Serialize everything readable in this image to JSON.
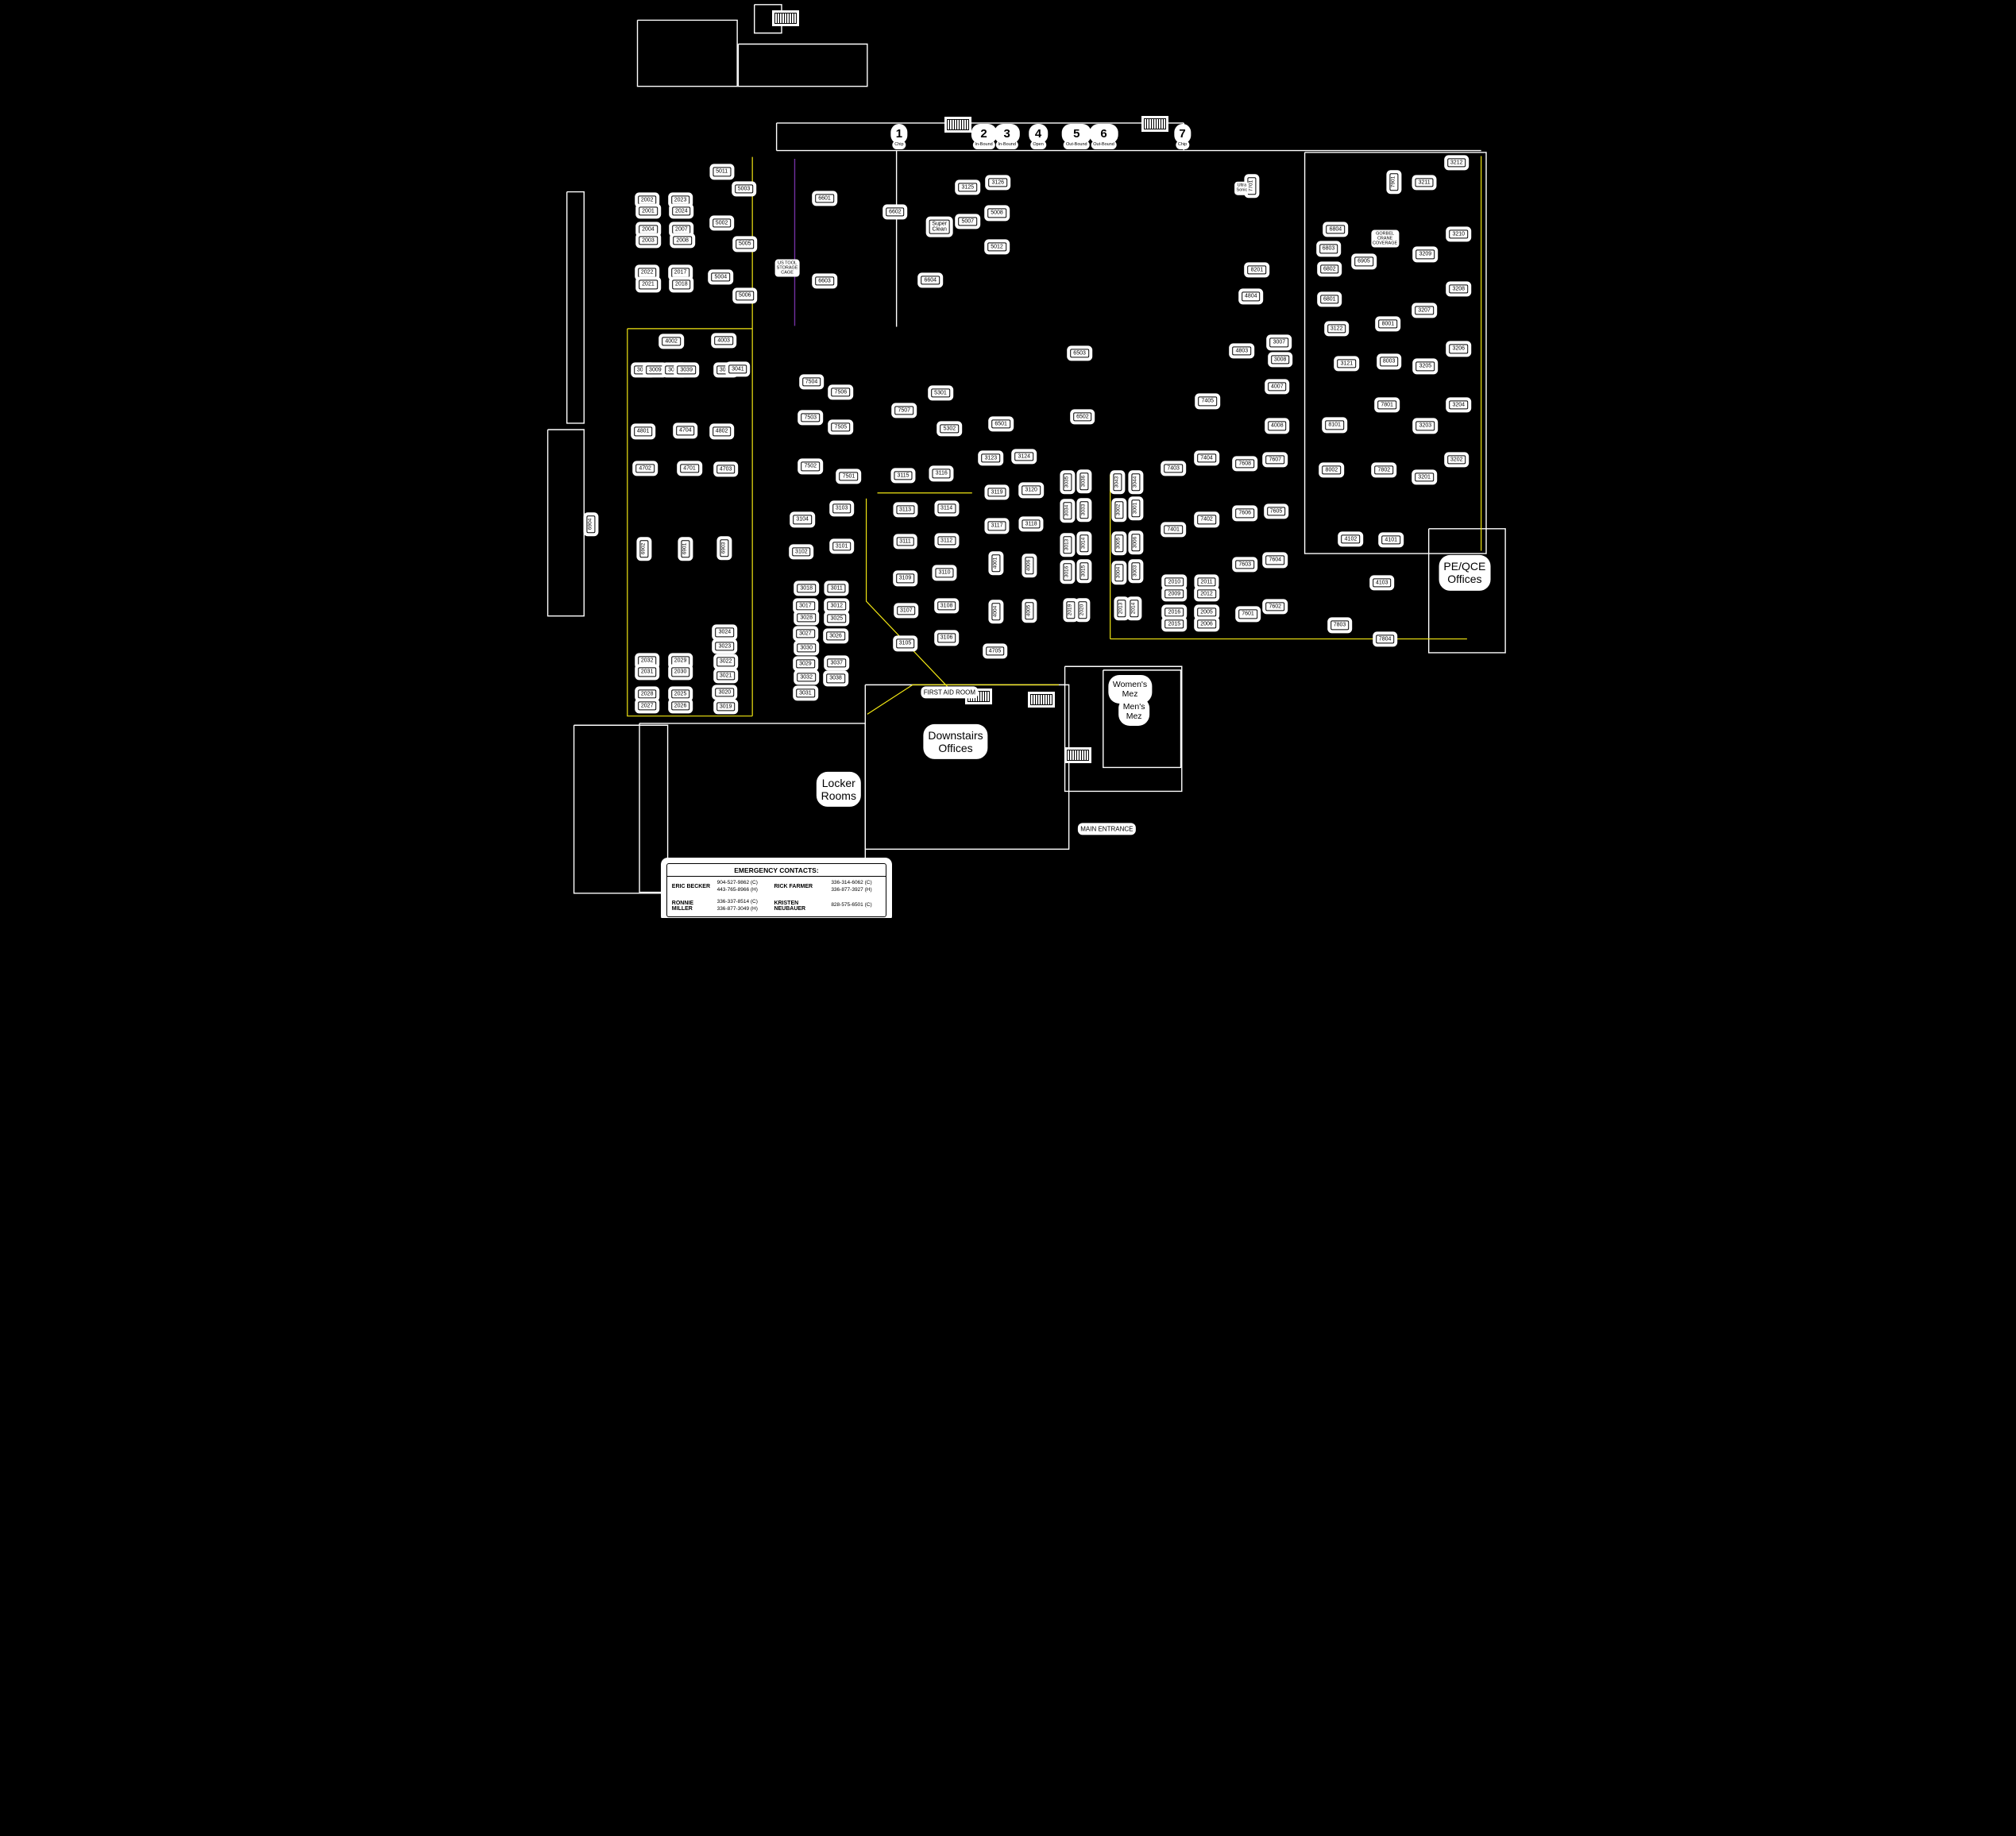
{
  "colors": {
    "background": "#000000",
    "linework": "#ffffff",
    "text": "#000000",
    "aisle_yellow": "#f2e713",
    "cage_purple": "#7030a0"
  },
  "dock_doors": [
    {
      "number": "1",
      "label": "Chip",
      "x": 39.2,
      "y": 13.9
    },
    {
      "number": "2",
      "label": "In-Bound",
      "x": 47.6,
      "y": 13.9
    },
    {
      "number": "3",
      "label": "In-Bound",
      "x": 49.9,
      "y": 13.9
    },
    {
      "number": "4",
      "label": "Open",
      "x": 53.0,
      "y": 13.9
    },
    {
      "number": "5",
      "label": "Out-Bound",
      "x": 56.8,
      "y": 13.9
    },
    {
      "number": "6",
      "label": "Out-Bound",
      "x": 59.5,
      "y": 13.9
    },
    {
      "number": "7",
      "label": "Chip",
      "x": 67.3,
      "y": 13.9
    }
  ],
  "machines": [
    {
      "t": "2002",
      "x": 14.2,
      "y": 21.8
    },
    {
      "t": "2001",
      "x": 14.3,
      "y": 23.0
    },
    {
      "t": "2004",
      "x": 14.3,
      "y": 25.0
    },
    {
      "t": "2003",
      "x": 14.3,
      "y": 26.2
    },
    {
      "t": "2022",
      "x": 14.2,
      "y": 29.7
    },
    {
      "t": "2021",
      "x": 14.3,
      "y": 31.0
    },
    {
      "t": "2023",
      "x": 17.5,
      "y": 21.8
    },
    {
      "t": "2024",
      "x": 17.6,
      "y": 23.0
    },
    {
      "t": "2007",
      "x": 17.6,
      "y": 25.0
    },
    {
      "t": "2008",
      "x": 17.7,
      "y": 26.2
    },
    {
      "t": "2017",
      "x": 17.5,
      "y": 29.7
    },
    {
      "t": "2018",
      "x": 17.6,
      "y": 31.0
    },
    {
      "t": "5011",
      "x": 21.6,
      "y": 18.7
    },
    {
      "t": "5003",
      "x": 23.8,
      "y": 20.6
    },
    {
      "t": "5002",
      "x": 21.6,
      "y": 24.3
    },
    {
      "t": "5005",
      "x": 23.9,
      "y": 26.6
    },
    {
      "t": "5004",
      "x": 21.5,
      "y": 30.2
    },
    {
      "t": "5006",
      "x": 23.9,
      "y": 32.2
    },
    {
      "t": "4002",
      "x": 16.6,
      "y": 37.2
    },
    {
      "t": "4003",
      "x": 21.8,
      "y": 37.1
    },
    {
      "t": "3010",
      "x": 13.8,
      "y": 40.3
    },
    {
      "t": "3009",
      "x": 15.0,
      "y": 40.3
    },
    {
      "t": "3040",
      "x": 16.9,
      "y": 40.3
    },
    {
      "t": "3039",
      "x": 18.1,
      "y": 40.3
    },
    {
      "t": "3042",
      "x": 22.0,
      "y": 40.3
    },
    {
      "t": "3041",
      "x": 23.2,
      "y": 40.2
    },
    {
      "t": "4801",
      "x": 13.8,
      "y": 47.0
    },
    {
      "t": "4704",
      "x": 18.0,
      "y": 46.9
    },
    {
      "t": "4802",
      "x": 21.6,
      "y": 47.0
    },
    {
      "t": "4702",
      "x": 14.0,
      "y": 51.0
    },
    {
      "t": "4701",
      "x": 18.4,
      "y": 51.0
    },
    {
      "t": "4703",
      "x": 22.0,
      "y": 51.1
    },
    {
      "t": "6904",
      "x": 8.6,
      "y": 57.1,
      "v": 1
    },
    {
      "t": "6902",
      "x": 13.9,
      "y": 59.8,
      "v": 1
    },
    {
      "t": "6901",
      "x": 18.0,
      "y": 59.8,
      "v": 1
    },
    {
      "t": "6903",
      "x": 21.9,
      "y": 59.7,
      "v": 1
    },
    {
      "t": "2032",
      "x": 14.2,
      "y": 72.0
    },
    {
      "t": "2031",
      "x": 14.2,
      "y": 73.2
    },
    {
      "t": "2029",
      "x": 17.5,
      "y": 72.0
    },
    {
      "t": "2030",
      "x": 17.5,
      "y": 73.2
    },
    {
      "t": "2028",
      "x": 14.2,
      "y": 75.6
    },
    {
      "t": "2027",
      "x": 14.2,
      "y": 76.9
    },
    {
      "t": "2025",
      "x": 17.5,
      "y": 75.6
    },
    {
      "t": "2026",
      "x": 17.5,
      "y": 76.9
    },
    {
      "t": "3024",
      "x": 21.9,
      "y": 68.9
    },
    {
      "t": "3023",
      "x": 21.9,
      "y": 70.4
    },
    {
      "t": "3022",
      "x": 22.0,
      "y": 72.1
    },
    {
      "t": "3021",
      "x": 22.0,
      "y": 73.6
    },
    {
      "t": "3020",
      "x": 21.9,
      "y": 75.4
    },
    {
      "t": "3019",
      "x": 22.0,
      "y": 77.0
    },
    {
      "t": "6601",
      "x": 31.8,
      "y": 21.6
    },
    {
      "t": "6602",
      "x": 38.8,
      "y": 23.1
    },
    {
      "t": "3125",
      "x": 46.0,
      "y": 20.4
    },
    {
      "t": "3126",
      "x": 49.0,
      "y": 19.9
    },
    {
      "t": "5007",
      "x": 46.0,
      "y": 24.1
    },
    {
      "t": "5008",
      "x": 48.9,
      "y": 23.2
    },
    {
      "t": "5012",
      "x": 48.9,
      "y": 26.9
    },
    {
      "t": "6603",
      "x": 31.8,
      "y": 30.6
    },
    {
      "t": "6604",
      "x": 42.3,
      "y": 30.5
    },
    {
      "t": "Super\nClean",
      "x": 43.2,
      "y": 24.7
    },
    {
      "t": "7504",
      "x": 30.5,
      "y": 41.6
    },
    {
      "t": "7506",
      "x": 33.4,
      "y": 42.7
    },
    {
      "t": "7503",
      "x": 30.4,
      "y": 45.5
    },
    {
      "t": "7505",
      "x": 33.4,
      "y": 46.5
    },
    {
      "t": "7502",
      "x": 30.4,
      "y": 50.8
    },
    {
      "t": "7501",
      "x": 34.2,
      "y": 51.9
    },
    {
      "t": "7507",
      "x": 39.7,
      "y": 44.7
    },
    {
      "t": "5301",
      "x": 43.3,
      "y": 42.8
    },
    {
      "t": "5302",
      "x": 44.2,
      "y": 46.7
    },
    {
      "t": "6501",
      "x": 49.3,
      "y": 46.2
    },
    {
      "t": "6502",
      "x": 57.4,
      "y": 45.4
    },
    {
      "t": "6503",
      "x": 57.1,
      "y": 38.5
    },
    {
      "t": "3115",
      "x": 39.6,
      "y": 51.8
    },
    {
      "t": "3116",
      "x": 43.4,
      "y": 51.6
    },
    {
      "t": "3113",
      "x": 39.8,
      "y": 55.5
    },
    {
      "t": "3114",
      "x": 43.9,
      "y": 55.4
    },
    {
      "t": "3111",
      "x": 39.8,
      "y": 59.0
    },
    {
      "t": "3112",
      "x": 43.9,
      "y": 58.9
    },
    {
      "t": "3109",
      "x": 39.8,
      "y": 63.0
    },
    {
      "t": "3110",
      "x": 43.7,
      "y": 62.4
    },
    {
      "t": "3107",
      "x": 39.9,
      "y": 66.5
    },
    {
      "t": "3108",
      "x": 43.9,
      "y": 66.0
    },
    {
      "t": "3105",
      "x": 39.8,
      "y": 70.1
    },
    {
      "t": "3106",
      "x": 43.9,
      "y": 69.5
    },
    {
      "t": "3104",
      "x": 29.6,
      "y": 56.6
    },
    {
      "t": "3103",
      "x": 33.5,
      "y": 55.4
    },
    {
      "t": "3102",
      "x": 29.5,
      "y": 60.1
    },
    {
      "t": "3101",
      "x": 33.5,
      "y": 59.5
    },
    {
      "t": "3018",
      "x": 30.0,
      "y": 64.1
    },
    {
      "t": "3017",
      "x": 29.9,
      "y": 66.0
    },
    {
      "t": "3028",
      "x": 30.0,
      "y": 67.3
    },
    {
      "t": "3027",
      "x": 29.9,
      "y": 69.0
    },
    {
      "t": "3030",
      "x": 30.0,
      "y": 70.6
    },
    {
      "t": "3029",
      "x": 29.9,
      "y": 72.3
    },
    {
      "t": "3032",
      "x": 30.0,
      "y": 73.8
    },
    {
      "t": "3031",
      "x": 29.9,
      "y": 75.5
    },
    {
      "t": "3011",
      "x": 33.0,
      "y": 64.1
    },
    {
      "t": "3012",
      "x": 33.0,
      "y": 66.0
    },
    {
      "t": "3025",
      "x": 33.0,
      "y": 67.4
    },
    {
      "t": "3026",
      "x": 32.9,
      "y": 69.3
    },
    {
      "t": "3037",
      "x": 33.0,
      "y": 72.2
    },
    {
      "t": "3038",
      "x": 32.9,
      "y": 73.9
    },
    {
      "t": "3123",
      "x": 48.3,
      "y": 49.9
    },
    {
      "t": "3124",
      "x": 51.6,
      "y": 49.7
    },
    {
      "t": "3119",
      "x": 48.9,
      "y": 53.6
    },
    {
      "t": "3120",
      "x": 52.3,
      "y": 53.4
    },
    {
      "t": "3117",
      "x": 48.9,
      "y": 57.3
    },
    {
      "t": "3118",
      "x": 52.3,
      "y": 57.1
    },
    {
      "t": "4001",
      "x": 48.8,
      "y": 61.3,
      "v": 1
    },
    {
      "t": "4006",
      "x": 52.1,
      "y": 61.6,
      "v": 1
    },
    {
      "t": "4004",
      "x": 48.8,
      "y": 66.6,
      "v": 1
    },
    {
      "t": "4005",
      "x": 52.1,
      "y": 66.5,
      "v": 1
    },
    {
      "t": "4705",
      "x": 48.7,
      "y": 70.9
    },
    {
      "t": "3035",
      "x": 55.9,
      "y": 52.5,
      "v": 1
    },
    {
      "t": "3036",
      "x": 57.6,
      "y": 52.4,
      "v": 1
    },
    {
      "t": "3034",
      "x": 55.9,
      "y": 55.6,
      "v": 1
    },
    {
      "t": "3033",
      "x": 57.6,
      "y": 55.5,
      "v": 1
    },
    {
      "t": "3013",
      "x": 55.9,
      "y": 59.3,
      "v": 1
    },
    {
      "t": "3014",
      "x": 57.6,
      "y": 59.2,
      "v": 1
    },
    {
      "t": "3016",
      "x": 55.9,
      "y": 62.3,
      "v": 1
    },
    {
      "t": "3015",
      "x": 57.6,
      "y": 62.2,
      "v": 1
    },
    {
      "t": "2019",
      "x": 56.2,
      "y": 66.4,
      "v": 1
    },
    {
      "t": "2020",
      "x": 57.4,
      "y": 66.4,
      "v": 1
    },
    {
      "t": "3043",
      "x": 60.9,
      "y": 52.5,
      "v": 1
    },
    {
      "t": "3044",
      "x": 62.7,
      "y": 52.5,
      "v": 1
    },
    {
      "t": "3002",
      "x": 61.0,
      "y": 55.5,
      "v": 1
    },
    {
      "t": "3001",
      "x": 62.7,
      "y": 55.4,
      "v": 1
    },
    {
      "t": "3005",
      "x": 61.0,
      "y": 59.2,
      "v": 1
    },
    {
      "t": "3006",
      "x": 62.7,
      "y": 59.1,
      "v": 1
    },
    {
      "t": "3004",
      "x": 61.0,
      "y": 62.4,
      "v": 1
    },
    {
      "t": "3003",
      "x": 62.7,
      "y": 62.2,
      "v": 1
    },
    {
      "t": "2013",
      "x": 61.3,
      "y": 66.3,
      "v": 1
    },
    {
      "t": "2014",
      "x": 62.5,
      "y": 66.3,
      "v": 1
    },
    {
      "t": "2010",
      "x": 66.5,
      "y": 63.4
    },
    {
      "t": "2009",
      "x": 66.5,
      "y": 64.7
    },
    {
      "t": "2011",
      "x": 69.7,
      "y": 63.4
    },
    {
      "t": "2012",
      "x": 69.7,
      "y": 64.7
    },
    {
      "t": "2016",
      "x": 66.5,
      "y": 66.7
    },
    {
      "t": "2015",
      "x": 66.5,
      "y": 68.0
    },
    {
      "t": "2005",
      "x": 69.7,
      "y": 66.7
    },
    {
      "t": "2006",
      "x": 69.7,
      "y": 68.0
    },
    {
      "t": "7401",
      "x": 66.4,
      "y": 57.7
    },
    {
      "t": "7402",
      "x": 69.7,
      "y": 56.6
    },
    {
      "t": "7403",
      "x": 66.4,
      "y": 51.0
    },
    {
      "t": "7404",
      "x": 69.7,
      "y": 49.9
    },
    {
      "t": "7405",
      "x": 69.8,
      "y": 43.7
    },
    {
      "t": "7608",
      "x": 73.5,
      "y": 50.5
    },
    {
      "t": "7607",
      "x": 76.5,
      "y": 50.1
    },
    {
      "t": "7606",
      "x": 73.5,
      "y": 55.9
    },
    {
      "t": "7605",
      "x": 76.6,
      "y": 55.7
    },
    {
      "t": "7603",
      "x": 73.5,
      "y": 61.5
    },
    {
      "t": "7604",
      "x": 76.5,
      "y": 61.0
    },
    {
      "t": "7601",
      "x": 73.8,
      "y": 66.9
    },
    {
      "t": "7602",
      "x": 76.5,
      "y": 66.1
    },
    {
      "t": "4007",
      "x": 76.7,
      "y": 42.1
    },
    {
      "t": "4008",
      "x": 76.7,
      "y": 46.4
    },
    {
      "t": "4803",
      "x": 73.2,
      "y": 38.2
    },
    {
      "t": "4804",
      "x": 74.1,
      "y": 32.3
    },
    {
      "t": "3007",
      "x": 76.9,
      "y": 37.3
    },
    {
      "t": "3008",
      "x": 77.0,
      "y": 39.2
    },
    {
      "t": "7701",
      "x": 74.2,
      "y": 20.2,
      "v": 1
    },
    {
      "t": "7901",
      "x": 88.3,
      "y": 19.8,
      "v": 1
    },
    {
      "t": "8201",
      "x": 74.7,
      "y": 29.4
    },
    {
      "t": "6804",
      "x": 82.5,
      "y": 25.0
    },
    {
      "t": "6803",
      "x": 81.8,
      "y": 27.1
    },
    {
      "t": "6802",
      "x": 81.9,
      "y": 29.3
    },
    {
      "t": "6801",
      "x": 81.9,
      "y": 32.6
    },
    {
      "t": "6905",
      "x": 85.3,
      "y": 28.5
    },
    {
      "t": "3122",
      "x": 82.6,
      "y": 35.8
    },
    {
      "t": "3121",
      "x": 83.6,
      "y": 39.6
    },
    {
      "t": "8001",
      "x": 87.7,
      "y": 35.3
    },
    {
      "t": "8003",
      "x": 87.8,
      "y": 39.4
    },
    {
      "t": "7801",
      "x": 87.6,
      "y": 44.1
    },
    {
      "t": "8101",
      "x": 82.4,
      "y": 46.3
    },
    {
      "t": "8002",
      "x": 82.1,
      "y": 51.2
    },
    {
      "t": "7802",
      "x": 87.3,
      "y": 51.2
    },
    {
      "t": "3212",
      "x": 94.5,
      "y": 17.7
    },
    {
      "t": "3211",
      "x": 91.3,
      "y": 19.9
    },
    {
      "t": "3210",
      "x": 94.7,
      "y": 25.5
    },
    {
      "t": "3209",
      "x": 91.4,
      "y": 27.7
    },
    {
      "t": "3208",
      "x": 94.7,
      "y": 31.5
    },
    {
      "t": "3207",
      "x": 91.3,
      "y": 33.8
    },
    {
      "t": "3206",
      "x": 94.7,
      "y": 38.0
    },
    {
      "t": "3205",
      "x": 91.4,
      "y": 39.9
    },
    {
      "t": "3204",
      "x": 94.7,
      "y": 44.1
    },
    {
      "t": "3203",
      "x": 91.4,
      "y": 46.4
    },
    {
      "t": "3202",
      "x": 94.5,
      "y": 50.1
    },
    {
      "t": "3201",
      "x": 91.3,
      "y": 52.0
    },
    {
      "t": "4102",
      "x": 84.0,
      "y": 58.7
    },
    {
      "t": "4101",
      "x": 88.0,
      "y": 58.8
    },
    {
      "t": "4103",
      "x": 87.1,
      "y": 63.5
    },
    {
      "t": "7803",
      "x": 82.9,
      "y": 68.1
    },
    {
      "t": "7804",
      "x": 87.4,
      "y": 69.6
    }
  ],
  "area_labels": [
    {
      "t": "US TOOL\nSTORAGE\nCAGE",
      "x": 28.1,
      "y": 29.2,
      "s": "xs"
    },
    {
      "t": "Ultra\nSonic",
      "x": 73.2,
      "y": 20.5,
      "s": "xs"
    },
    {
      "t": "GORBEL\nCRANE\nCOVERAGE",
      "x": 87.4,
      "y": 26.0,
      "s": "xs"
    },
    {
      "t": "FIRST AID ROOM",
      "x": 44.2,
      "y": 75.4,
      "s": "s"
    },
    {
      "t": "Downstairs\nOffices",
      "x": 44.8,
      "y": 80.8,
      "s": "l"
    },
    {
      "t": "Locker\nRooms",
      "x": 33.2,
      "y": 86.0,
      "s": "l"
    },
    {
      "t": "Women's\nMez",
      "x": 62.1,
      "y": 75.1,
      "s": "m"
    },
    {
      "t": "Men's\nMez",
      "x": 62.5,
      "y": 77.5,
      "s": "m"
    },
    {
      "t": "PE/QCE\nOffices",
      "x": 95.3,
      "y": 62.4,
      "s": "l"
    },
    {
      "t": "MAIN ENTRANCE",
      "x": 59.8,
      "y": 90.3,
      "s": "s"
    }
  ],
  "aisle_lines": [
    {
      "pts": [
        [
          24.6,
          17.1
        ],
        [
          24.6,
          78.0
        ]
      ]
    },
    {
      "pts": [
        [
          12.2,
          35.8
        ],
        [
          24.6,
          35.8
        ]
      ]
    },
    {
      "pts": [
        [
          12.2,
          35.8
        ],
        [
          12.2,
          78.0
        ],
        [
          24.6,
          78.0
        ]
      ]
    },
    {
      "pts": [
        [
          37.0,
          53.7
        ],
        [
          46.4,
          53.7
        ]
      ]
    },
    {
      "pts": [
        [
          35.9,
          54.3
        ],
        [
          35.9,
          65.5
        ],
        [
          44.3,
          75.2
        ]
      ]
    },
    {
      "pts": [
        [
          60.1,
          51.7
        ],
        [
          60.1,
          69.6
        ]
      ]
    },
    {
      "pts": [
        [
          60.1,
          69.6
        ],
        [
          95.5,
          69.6
        ]
      ]
    },
    {
      "pts": [
        [
          96.9,
          17.0
        ],
        [
          96.9,
          60.0
        ]
      ]
    },
    {
      "pts": [
        [
          36.0,
          77.8
        ],
        [
          40.5,
          74.6
        ],
        [
          55.0,
          74.6
        ]
      ]
    }
  ],
  "cage_lines": [
    {
      "pts": [
        [
          28.8,
          17.3
        ],
        [
          28.8,
          35.5
        ]
      ]
    }
  ],
  "wall_lines": [
    {
      "pts": [
        [
          27.0,
          13.4
        ],
        [
          67.4,
          13.4
        ]
      ]
    },
    {
      "pts": [
        [
          27.0,
          16.4
        ],
        [
          96.9,
          16.4
        ]
      ]
    },
    {
      "pts": [
        [
          27.0,
          13.4
        ],
        [
          27.0,
          16.4
        ]
      ]
    },
    {
      "pts": [
        [
          67.4,
          13.4
        ],
        [
          67.4,
          16.4
        ]
      ]
    },
    {
      "pts": [
        [
          38.9,
          16.4
        ],
        [
          38.9,
          35.6
        ]
      ]
    }
  ],
  "wall_rects": [
    {
      "x": 13.2,
      "y": 2.2,
      "w": 9.9,
      "h": 7.2
    },
    {
      "x": 24.8,
      "y": 0.5,
      "w": 2.7,
      "h": 3.1
    },
    {
      "x": 23.2,
      "y": 4.8,
      "w": 12.8,
      "h": 4.6
    },
    {
      "x": 79.4,
      "y": 16.6,
      "w": 18.0,
      "h": 43.7
    },
    {
      "x": 91.7,
      "y": 57.6,
      "w": 7.6,
      "h": 13.5
    },
    {
      "x": 55.6,
      "y": 72.6,
      "w": 11.6,
      "h": 13.6
    },
    {
      "x": 13.4,
      "y": 78.8,
      "w": 22.4,
      "h": 18.4
    },
    {
      "x": 35.8,
      "y": 74.6,
      "w": 20.2,
      "h": 17.9
    },
    {
      "x": 6.2,
      "y": 20.9,
      "w": 1.7,
      "h": 25.2
    },
    {
      "x": 4.3,
      "y": 46.8,
      "w": 3.6,
      "h": 20.3
    },
    {
      "x": 6.9,
      "y": 79.0,
      "w": 9.3,
      "h": 18.3
    },
    {
      "x": 59.4,
      "y": 73.0,
      "w": 7.7,
      "h": 10.6
    }
  ],
  "stairs": [
    {
      "x": 45.0,
      "y": 13.6
    },
    {
      "x": 64.6,
      "y": 13.5
    },
    {
      "x": 47.1,
      "y": 75.9
    },
    {
      "x": 53.3,
      "y": 76.2
    },
    {
      "x": 56.9,
      "y": 82.3
    },
    {
      "x": 27.9,
      "y": 2.0
    }
  ],
  "emergency_contacts": {
    "header": "EMERGENCY CONTACTS:",
    "box": {
      "x": 16.1,
      "y": 94.0,
      "w": 21.7,
      "h": 5.7
    },
    "entries": [
      {
        "name": "ERIC BECKER",
        "phones": "904-527-9862 (C)\n443-765-8966 (H)"
      },
      {
        "name": "RICK FARMER",
        "phones": "336-314-6062 (C)\n336-877-3927 (H)"
      },
      {
        "name": "RONNIE MILLER",
        "phones": "336-337-8514 (C)\n336-877-3049 (H)"
      },
      {
        "name": "KRISTEN NEUBAUER",
        "phones": "828-575-6501 (C)"
      }
    ]
  }
}
